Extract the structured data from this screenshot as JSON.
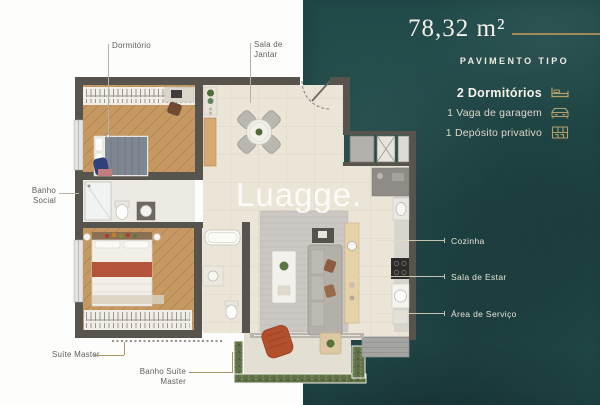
{
  "watermark": "Luagge.",
  "info_panel": {
    "area_value": "78,32 m²",
    "subtitle": "PAVIMENTO TIPO",
    "features": [
      {
        "label": "2 Dormitórios",
        "icon": "bed-icon"
      },
      {
        "label": "1 Vaga de garagem",
        "icon": "car-icon"
      },
      {
        "label": "1 Depósito privativo",
        "icon": "storage-icon"
      }
    ],
    "colors": {
      "background": "#214a49",
      "accent_gold": "#a8915c",
      "text_light": "#f1eee5"
    }
  },
  "floor_plan_labels": {
    "dormitorio": "Dormitório",
    "sala_de_jantar": "Sala de\nJantar",
    "banho_social": "Banho\nSocial",
    "suite_master": "Suíte Master",
    "banho_suite_master": "Banho Suíte\nMaster",
    "cozinha": "Cozinha",
    "sala_de_estar": "Sala de Estar",
    "area_de_servico": "Área de Serviço"
  }
}
